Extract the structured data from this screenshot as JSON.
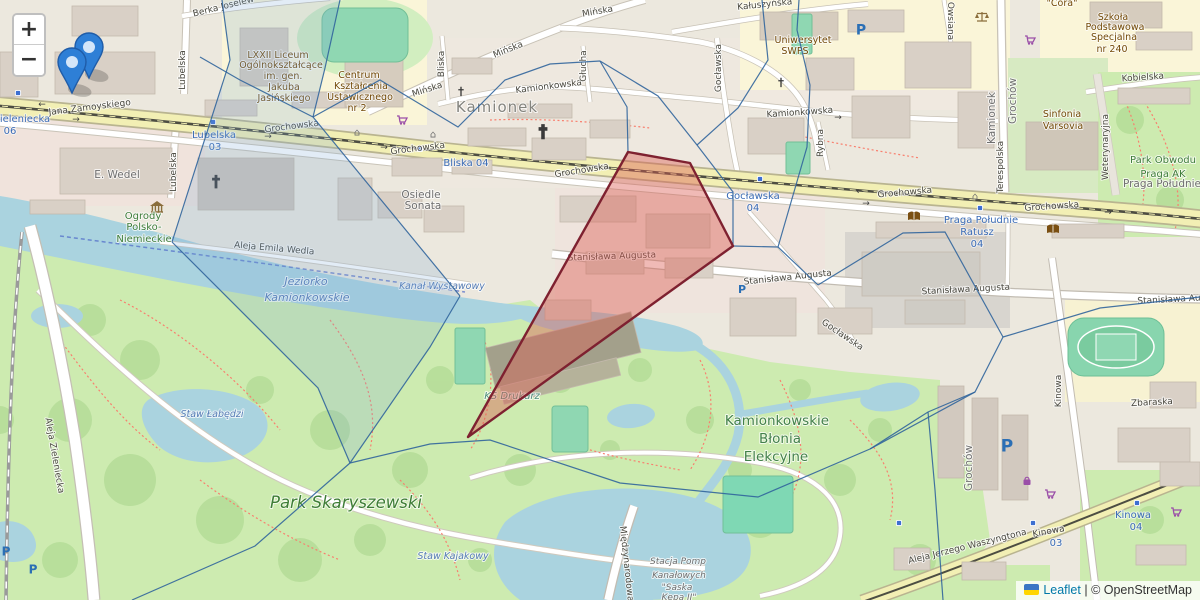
{
  "controls": {
    "zoom_in": "+",
    "zoom_out": "−"
  },
  "attribution": {
    "flag_icon": "ukraine-flag",
    "library": "Leaflet",
    "separator": "|",
    "copyright": "© OpenStreetMap"
  },
  "overlay": {
    "mesh_color": "#31659c",
    "cell_fill": "#7ba7d6",
    "cell_opacity": 0.22,
    "red_stroke": "#7e2130",
    "red_fill": "#dc5a52",
    "red_opacity": 0.42,
    "highlight_cell": [
      [
        222,
        0
      ],
      [
        340,
        0
      ],
      [
        325,
        68
      ],
      [
        313,
        117
      ],
      [
        460,
        296
      ],
      [
        430,
        347
      ],
      [
        350,
        463
      ],
      [
        318,
        388
      ],
      [
        172,
        242
      ],
      [
        230,
        60
      ]
    ],
    "red_polygon": [
      [
        628,
        152
      ],
      [
        690,
        163
      ],
      [
        733,
        246
      ],
      [
        468,
        437
      ]
    ],
    "mesh_lines": [
      [
        [
          222,
          0
        ],
        [
          230,
          60
        ],
        [
          172,
          242
        ]
      ],
      [
        [
          172,
          242
        ],
        [
          318,
          388
        ],
        [
          350,
          463
        ]
      ],
      [
        [
          350,
          463
        ],
        [
          255,
          546
        ],
        [
          132,
          600
        ]
      ],
      [
        [
          200,
          57
        ],
        [
          240,
          80
        ],
        [
          313,
          117
        ]
      ],
      [
        [
          340,
          0
        ],
        [
          325,
          68
        ],
        [
          313,
          117
        ]
      ],
      [
        [
          313,
          117
        ],
        [
          460,
          296
        ]
      ],
      [
        [
          460,
          296
        ],
        [
          430,
          347
        ],
        [
          350,
          463
        ]
      ],
      [
        [
          313,
          117
        ],
        [
          380,
          80
        ],
        [
          458,
          127
        ],
        [
          505,
          80
        ],
        [
          550,
          64
        ],
        [
          600,
          61
        ]
      ],
      [
        [
          600,
          61
        ],
        [
          627,
          107
        ],
        [
          628,
          152
        ]
      ],
      [
        [
          600,
          61
        ],
        [
          658,
          96
        ],
        [
          697,
          145
        ],
        [
          733,
          192
        ],
        [
          733,
          246
        ]
      ],
      [
        [
          697,
          145
        ],
        [
          738,
          108
        ],
        [
          768,
          60
        ],
        [
          762,
          0
        ]
      ],
      [
        [
          733,
          246
        ],
        [
          778,
          247
        ],
        [
          818,
          285
        ]
      ],
      [
        [
          778,
          247
        ],
        [
          807,
          147
        ],
        [
          810,
          85
        ],
        [
          797,
          30
        ],
        [
          799,
          0
        ]
      ],
      [
        [
          818,
          285
        ],
        [
          903,
          233
        ],
        [
          945,
          232
        ],
        [
          1003,
          337
        ]
      ],
      [
        [
          1003,
          337
        ],
        [
          975,
          392
        ],
        [
          870,
          449
        ]
      ],
      [
        [
          350,
          463
        ],
        [
          430,
          444
        ],
        [
          490,
          440
        ],
        [
          620,
          483
        ],
        [
          758,
          497
        ],
        [
          870,
          449
        ]
      ],
      [
        [
          870,
          449
        ],
        [
          928,
          412
        ],
        [
          975,
          392
        ]
      ],
      [
        [
          1003,
          337
        ],
        [
          1100,
          308
        ],
        [
          1200,
          297
        ]
      ],
      [
        [
          928,
          412
        ],
        [
          935,
          490
        ],
        [
          943,
          600
        ]
      ]
    ],
    "markers": [
      {
        "x": 89,
        "y": 78
      },
      {
        "x": 72,
        "y": 93
      }
    ]
  },
  "map": {
    "labels": [
      {
        "t": "Jana Zamoyskiego",
        "x": 90,
        "y": 110,
        "c": "st",
        "r": -7
      },
      {
        "t": "Grochowska",
        "x": 292,
        "y": 129,
        "c": "st",
        "r": -7
      },
      {
        "t": "Grochowska",
        "x": 418,
        "y": 151,
        "c": "st",
        "r": -7
      },
      {
        "t": "Grochowska",
        "x": 582,
        "y": 173,
        "c": "st",
        "r": -9
      },
      {
        "t": "Grochowska",
        "x": 905,
        "y": 195,
        "c": "st",
        "r": -5
      },
      {
        "t": "Grochowska",
        "x": 1052,
        "y": 209,
        "c": "st",
        "r": -4
      },
      {
        "t": "Stanisława Augusta",
        "x": 612,
        "y": 259,
        "c": "st",
        "r": -2
      },
      {
        "t": "Stanisława Augusta",
        "x": 788,
        "y": 280,
        "c": "st",
        "r": -6
      },
      {
        "t": "Stanisława Augusta",
        "x": 966,
        "y": 292,
        "c": "st",
        "r": -3
      },
      {
        "t": "Stanisława Aug",
        "x": 1172,
        "y": 302,
        "c": "st",
        "r": -3
      },
      {
        "t": "Kamionkowska",
        "x": 549,
        "y": 89,
        "c": "st",
        "r": -7
      },
      {
        "t": "Kamionkowska",
        "x": 800,
        "y": 115,
        "c": "st",
        "r": -4
      },
      {
        "t": "Mińska",
        "x": 428,
        "y": 92,
        "c": "st",
        "r": -18
      },
      {
        "t": "Mińska",
        "x": 509,
        "y": 52,
        "c": "st",
        "r": -22
      },
      {
        "t": "Mińska",
        "x": 598,
        "y": 14,
        "c": "st",
        "r": -10
      },
      {
        "t": "Bliska",
        "x": 444,
        "y": 64,
        "c": "st",
        "r": -90
      },
      {
        "t": "Lubelska",
        "x": 185,
        "y": 70,
        "c": "st",
        "r": -90
      },
      {
        "t": "Lubelska",
        "x": 176,
        "y": 172,
        "c": "st",
        "r": -90
      },
      {
        "t": "Głucha",
        "x": 586,
        "y": 66,
        "c": "st",
        "r": -90
      },
      {
        "t": "Gocławska",
        "x": 721,
        "y": 68,
        "c": "st",
        "r": -90
      },
      {
        "t": "Gocławska",
        "x": 841,
        "y": 337,
        "c": "st",
        "r": 34
      },
      {
        "t": "Rybna",
        "x": 823,
        "y": 143,
        "c": "st",
        "r": -90
      },
      {
        "t": "Terespolska",
        "x": 1003,
        "y": 167,
        "c": "st",
        "r": -90
      },
      {
        "t": "Weterynaryjna",
        "x": 1108,
        "y": 147,
        "c": "st",
        "r": -90
      },
      {
        "t": "Kobielska",
        "x": 1143,
        "y": 80,
        "c": "st",
        "r": -4
      },
      {
        "t": "Owsiana",
        "x": 948,
        "y": 21,
        "c": "st",
        "r": 90
      },
      {
        "t": "Kałuszyńska",
        "x": 765,
        "y": 7,
        "c": "st",
        "r": -6
      },
      {
        "t": "Berka Joselew",
        "x": 224,
        "y": 9,
        "c": "st",
        "r": -14
      },
      {
        "t": "Aleja Emila Wedla",
        "x": 274,
        "y": 251,
        "c": "st",
        "r": 5
      },
      {
        "t": "Aleja Zieleniecka",
        "x": 52,
        "y": 456,
        "c": "st",
        "r": 80
      },
      {
        "t": "Aleja Jerzego Waszyngtona",
        "x": 968,
        "y": 549,
        "c": "st",
        "r": -14
      },
      {
        "t": "Międzynarodowa",
        "x": 624,
        "y": 564,
        "c": "st",
        "r": 84
      },
      {
        "t": "Kinowa",
        "x": 1061,
        "y": 391,
        "c": "st",
        "r": -90
      },
      {
        "t": "Kinowa",
        "x": 1049,
        "y": 534,
        "c": "st",
        "r": -10
      },
      {
        "t": "Zbaraska",
        "x": 1152,
        "y": 405,
        "c": "st",
        "r": -3
      },
      {
        "t": "Kamionek",
        "x": 995,
        "y": 118,
        "c": "pl",
        "r": -90
      },
      {
        "t": "Grochów",
        "x": 1016,
        "y": 101,
        "c": "pl",
        "r": -90
      },
      {
        "t": "Grochów",
        "x": 972,
        "y": 468,
        "c": "pl",
        "r": -90
      },
      {
        "t": "ieleniecka",
        "x": 25,
        "y": 122,
        "c": "tr"
      },
      {
        "t": "06",
        "x": 10,
        "y": 134,
        "c": "tr"
      },
      {
        "t": "Lubelska",
        "x": 214,
        "y": 138,
        "c": "tr"
      },
      {
        "t": "03",
        "x": 215,
        "y": 150,
        "c": "tr"
      },
      {
        "t": "Bliska 04",
        "x": 466,
        "y": 166,
        "c": "tr"
      },
      {
        "t": "Gocławska",
        "x": 753,
        "y": 199,
        "c": "tr"
      },
      {
        "t": "04",
        "x": 753,
        "y": 211,
        "c": "tr"
      },
      {
        "t": "Praga Południe",
        "x": 981,
        "y": 223,
        "c": "tr"
      },
      {
        "t": "Ratusz",
        "x": 977,
        "y": 235,
        "c": "tr"
      },
      {
        "t": "04",
        "x": 977,
        "y": 247,
        "c": "tr"
      },
      {
        "t": "03",
        "x": 1056,
        "y": 546,
        "c": "tr"
      },
      {
        "t": "Kinowa",
        "x": 1133,
        "y": 518,
        "c": "tr"
      },
      {
        "t": "04",
        "x": 1136,
        "y": 530,
        "c": "tr"
      },
      {
        "t": "Kamionek",
        "x": 497,
        "y": 112,
        "c": "pl-lg"
      },
      {
        "t": "Osiedle",
        "x": 421,
        "y": 198,
        "c": "pl"
      },
      {
        "t": "Sonata",
        "x": 423,
        "y": 209,
        "c": "pl"
      },
      {
        "t": "Praga Południe",
        "x": 1162,
        "y": 187,
        "c": "pl"
      },
      {
        "t": "E. Wedel",
        "x": 117,
        "y": 178,
        "c": "pl"
      },
      {
        "t": "LXXII Liceum",
        "x": 278,
        "y": 58,
        "c": "poi"
      },
      {
        "t": "Ogólnokształcące",
        "x": 281,
        "y": 68,
        "c": "poi"
      },
      {
        "t": "im. gen.",
        "x": 283,
        "y": 79,
        "c": "poi"
      },
      {
        "t": "Jakuba",
        "x": 284,
        "y": 90,
        "c": "poi"
      },
      {
        "t": "Jasińskiego",
        "x": 284,
        "y": 101,
        "c": "poi"
      },
      {
        "t": "Centrum",
        "x": 359,
        "y": 78,
        "c": "poi"
      },
      {
        "t": "Kształcenia",
        "x": 361,
        "y": 89,
        "c": "poi"
      },
      {
        "t": "Ustawicznego",
        "x": 360,
        "y": 100,
        "c": "poi"
      },
      {
        "t": "nr 2",
        "x": 357,
        "y": 111,
        "c": "poi"
      },
      {
        "t": "Uniwersytet",
        "x": 803,
        "y": 43,
        "c": "poi"
      },
      {
        "t": "SWPS",
        "x": 795,
        "y": 54,
        "c": "poi"
      },
      {
        "t": "Szkoła",
        "x": 1113,
        "y": 20,
        "c": "poi"
      },
      {
        "t": "Podstawowa",
        "x": 1115,
        "y": 30,
        "c": "poi"
      },
      {
        "t": "Specjalna",
        "x": 1114,
        "y": 40,
        "c": "poi"
      },
      {
        "t": "nr 240",
        "x": 1112,
        "y": 52,
        "c": "poi"
      },
      {
        "t": "Sinfonia",
        "x": 1062,
        "y": 117,
        "c": "poi"
      },
      {
        "t": "Varsovia",
        "x": 1063,
        "y": 129,
        "c": "poi"
      },
      {
        "t": "\"Cora\"",
        "x": 1062,
        "y": 6,
        "c": "poi"
      },
      {
        "t": "Ogrody",
        "x": 143,
        "y": 219,
        "c": "pk"
      },
      {
        "t": "Polsko-",
        "x": 144,
        "y": 230,
        "c": "pk"
      },
      {
        "t": "Niemieckie",
        "x": 144,
        "y": 242,
        "c": "pk"
      },
      {
        "t": "Park Skaryszewski",
        "x": 346,
        "y": 508,
        "c": "pk-lg"
      },
      {
        "t": "Kamionkowskie",
        "x": 777,
        "y": 425,
        "c": "pk-md"
      },
      {
        "t": "Błonia",
        "x": 780,
        "y": 443,
        "c": "pk-md"
      },
      {
        "t": "Elekcyjne",
        "x": 776,
        "y": 461,
        "c": "pk-md"
      },
      {
        "t": "Park Obwodu",
        "x": 1163,
        "y": 163,
        "c": "pk"
      },
      {
        "t": "Praga AK",
        "x": 1163,
        "y": 177,
        "c": "pk"
      },
      {
        "t": "KS Drukarz",
        "x": 512,
        "y": 399,
        "c": "pit"
      },
      {
        "t": "Jeziorko",
        "x": 306,
        "y": 285,
        "c": "wt"
      },
      {
        "t": "Kamionkowskie",
        "x": 307,
        "y": 301,
        "c": "wt"
      },
      {
        "t": "Kanał Wystawowy",
        "x": 442,
        "y": 289,
        "c": "wt-sm"
      },
      {
        "t": "Staw Łabędzi",
        "x": 212,
        "y": 417,
        "c": "wt-sm"
      },
      {
        "t": "Staw Kajakowy",
        "x": 453,
        "y": 559,
        "c": "wt-sm"
      },
      {
        "t": "Stacja Pomp",
        "x": 678,
        "y": 564,
        "c": "stn"
      },
      {
        "t": "Kanałowych",
        "x": 679,
        "y": 578,
        "c": "stn"
      },
      {
        "t": "\"Saska",
        "x": 677,
        "y": 590,
        "c": "stn"
      },
      {
        "t": "Kępa II\"",
        "x": 679,
        "y": 600,
        "c": "stn"
      }
    ],
    "icons": [
      {
        "type": "cross",
        "x": 216,
        "y": 181,
        "s": 16
      },
      {
        "type": "cross",
        "x": 543,
        "y": 131,
        "s": 18
      },
      {
        "type": "cross",
        "x": 461,
        "y": 91,
        "s": 11
      },
      {
        "type": "cross",
        "x": 781,
        "y": 82,
        "s": 11
      },
      {
        "type": "museum",
        "x": 157,
        "y": 207
      },
      {
        "type": "scales",
        "x": 982,
        "y": 17
      },
      {
        "type": "book",
        "x": 914,
        "y": 217
      },
      {
        "type": "book",
        "x": 1053,
        "y": 230
      },
      {
        "type": "cart",
        "x": 402,
        "y": 120
      },
      {
        "type": "cart",
        "x": 1030,
        "y": 40
      },
      {
        "type": "cart",
        "x": 1050,
        "y": 494
      },
      {
        "type": "cart",
        "x": 1176,
        "y": 512
      },
      {
        "type": "bag",
        "x": 1027,
        "y": 481
      },
      {
        "type": "parking",
        "x": 861,
        "y": 29,
        "s": 14
      },
      {
        "type": "parking",
        "x": 742,
        "y": 289,
        "s": 11
      },
      {
        "type": "parking",
        "x": 1007,
        "y": 445,
        "s": 17
      },
      {
        "type": "parking",
        "x": 6,
        "y": 551,
        "s": 12
      },
      {
        "type": "parking",
        "x": 33,
        "y": 569,
        "s": 12
      },
      {
        "type": "stop",
        "x": 18,
        "y": 93
      },
      {
        "type": "stop",
        "x": 213,
        "y": 122
      },
      {
        "type": "stop",
        "x": 420,
        "y": 149
      },
      {
        "type": "stop",
        "x": 760,
        "y": 179
      },
      {
        "type": "stop",
        "x": 980,
        "y": 208
      },
      {
        "type": "stop",
        "x": 899,
        "y": 523
      },
      {
        "type": "stop",
        "x": 1033,
        "y": 523
      },
      {
        "type": "stop",
        "x": 1137,
        "y": 503
      },
      {
        "type": "arrow",
        "t": "←",
        "x": 42,
        "y": 104
      },
      {
        "type": "arrow",
        "t": "→",
        "x": 76,
        "y": 119
      },
      {
        "type": "arrow",
        "t": "→",
        "x": 268,
        "y": 136
      },
      {
        "type": "arrow",
        "t": "→",
        "x": 384,
        "y": 147
      },
      {
        "type": "arrow",
        "t": "←",
        "x": 860,
        "y": 191
      },
      {
        "type": "arrow",
        "t": "→",
        "x": 866,
        "y": 203
      },
      {
        "type": "arrow",
        "t": "→",
        "x": 838,
        "y": 117
      },
      {
        "type": "arrow",
        "t": "→",
        "x": 1108,
        "y": 212
      },
      {
        "type": "house",
        "x": 433,
        "y": 134
      },
      {
        "type": "house",
        "x": 975,
        "y": 196
      },
      {
        "type": "house",
        "x": 357,
        "y": 132
      }
    ]
  }
}
